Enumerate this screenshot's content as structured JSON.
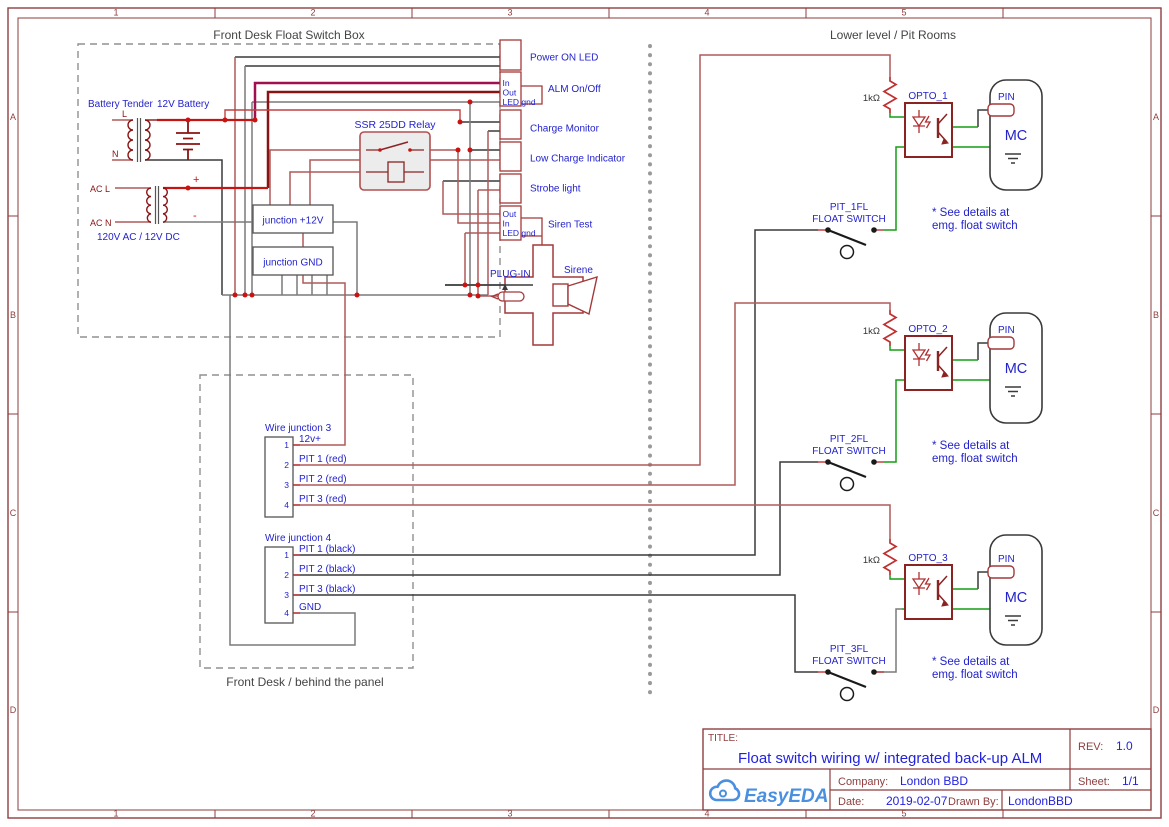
{
  "frame": {
    "cols": [
      "1",
      "2",
      "3",
      "4",
      "5"
    ],
    "rows": [
      "A",
      "B",
      "C",
      "D"
    ]
  },
  "titles": {
    "front_desk_box": "Front Desk Float Switch Box",
    "behind_panel_box": "Front Desk / behind the panel",
    "lower_level": "Lower level / Pit Rooms"
  },
  "power": {
    "battery_tender": "Battery Tender",
    "battery": "12V Battery",
    "l": "L",
    "n": "N",
    "ac_l": "AC L",
    "ac_n": "AC N",
    "converter": "120V AC / 12V DC",
    "plus": "+",
    "minus": "-"
  },
  "relay": {
    "name": "SSR 25DD Relay"
  },
  "junction_boxes": {
    "plus12": "junction +12V",
    "gnd": "junction GND"
  },
  "connector": {
    "power_on": "Power ON LED",
    "alm": "ALM On/Off",
    "charge": "Charge Monitor",
    "low_charge": "Low Charge Indicator",
    "strobe": "Strobe light",
    "siren_test": "Siren Test",
    "alm_pins": [
      "In",
      "Out",
      "LED gnd"
    ],
    "siren_pins": [
      "Out",
      "In",
      "LED gnd"
    ]
  },
  "plug_in": "PLUG-IN",
  "sirene": "Sirene",
  "wire_junction3": {
    "title": "Wire junction 3",
    "pins": [
      [
        "1",
        "12v+"
      ],
      [
        "2",
        "PIT 1 (red)"
      ],
      [
        "3",
        "PIT 2 (red)"
      ],
      [
        "4",
        "PIT 3 (red)"
      ]
    ]
  },
  "wire_junction4": {
    "title": "Wire junction 4",
    "pins": [
      [
        "1",
        "PIT 1 (black)"
      ],
      [
        "2",
        "PIT 2 (black)"
      ],
      [
        "3",
        "PIT 3 (black)"
      ],
      [
        "4",
        "GND"
      ]
    ]
  },
  "optos": [
    {
      "res": "1kΩ",
      "name": "OPTO_1",
      "pin": "PIN",
      "mc": "MC",
      "sw": "PIT_1FL",
      "sw_type": "FLOAT SWITCH",
      "note1": "* See details at",
      "note2": "emg. float switch"
    },
    {
      "res": "1kΩ",
      "name": "OPTO_2",
      "pin": "PIN",
      "mc": "MC",
      "sw": "PIT_2FL",
      "sw_type": "FLOAT SWITCH",
      "note1": "* See details at",
      "note2": "emg. float switch"
    },
    {
      "res": "1kΩ",
      "name": "OPTO_3",
      "pin": "PIN",
      "mc": "MC",
      "sw": "PIT_3FL",
      "sw_type": "FLOAT SWITCH",
      "note1": "* See details at",
      "note2": "emg. float switch"
    }
  ],
  "title_block": {
    "title_label": "TITLE:",
    "title": "Float switch wiring w/ integrated back-up ALM",
    "rev_label": "REV:",
    "rev": "1.0",
    "company_label": "Company:",
    "company": "London BBD",
    "sheet_label": "Sheet:",
    "sheet": "1/1",
    "date_label": "Date:",
    "date": "2019-02-07",
    "drawn_label": "Drawn By:",
    "drawn": "LondonBBD",
    "logo": "EasyEDA"
  },
  "colors": {
    "frame_red": "#8e3e3e",
    "label_blue": "#2323cc",
    "value_blue": "#2222dd",
    "wire_red": "#b05a5a",
    "wire_dark_red": "#8b1212",
    "wire_crimson": "#a01050",
    "wire_bright_red": "#c41414",
    "wire_black": "#3a3a3a",
    "wire_gray": "#7a7a7a",
    "wire_green": "#159e15",
    "component_red": "#8b2323",
    "logo_blue": "#4a8fe0"
  }
}
